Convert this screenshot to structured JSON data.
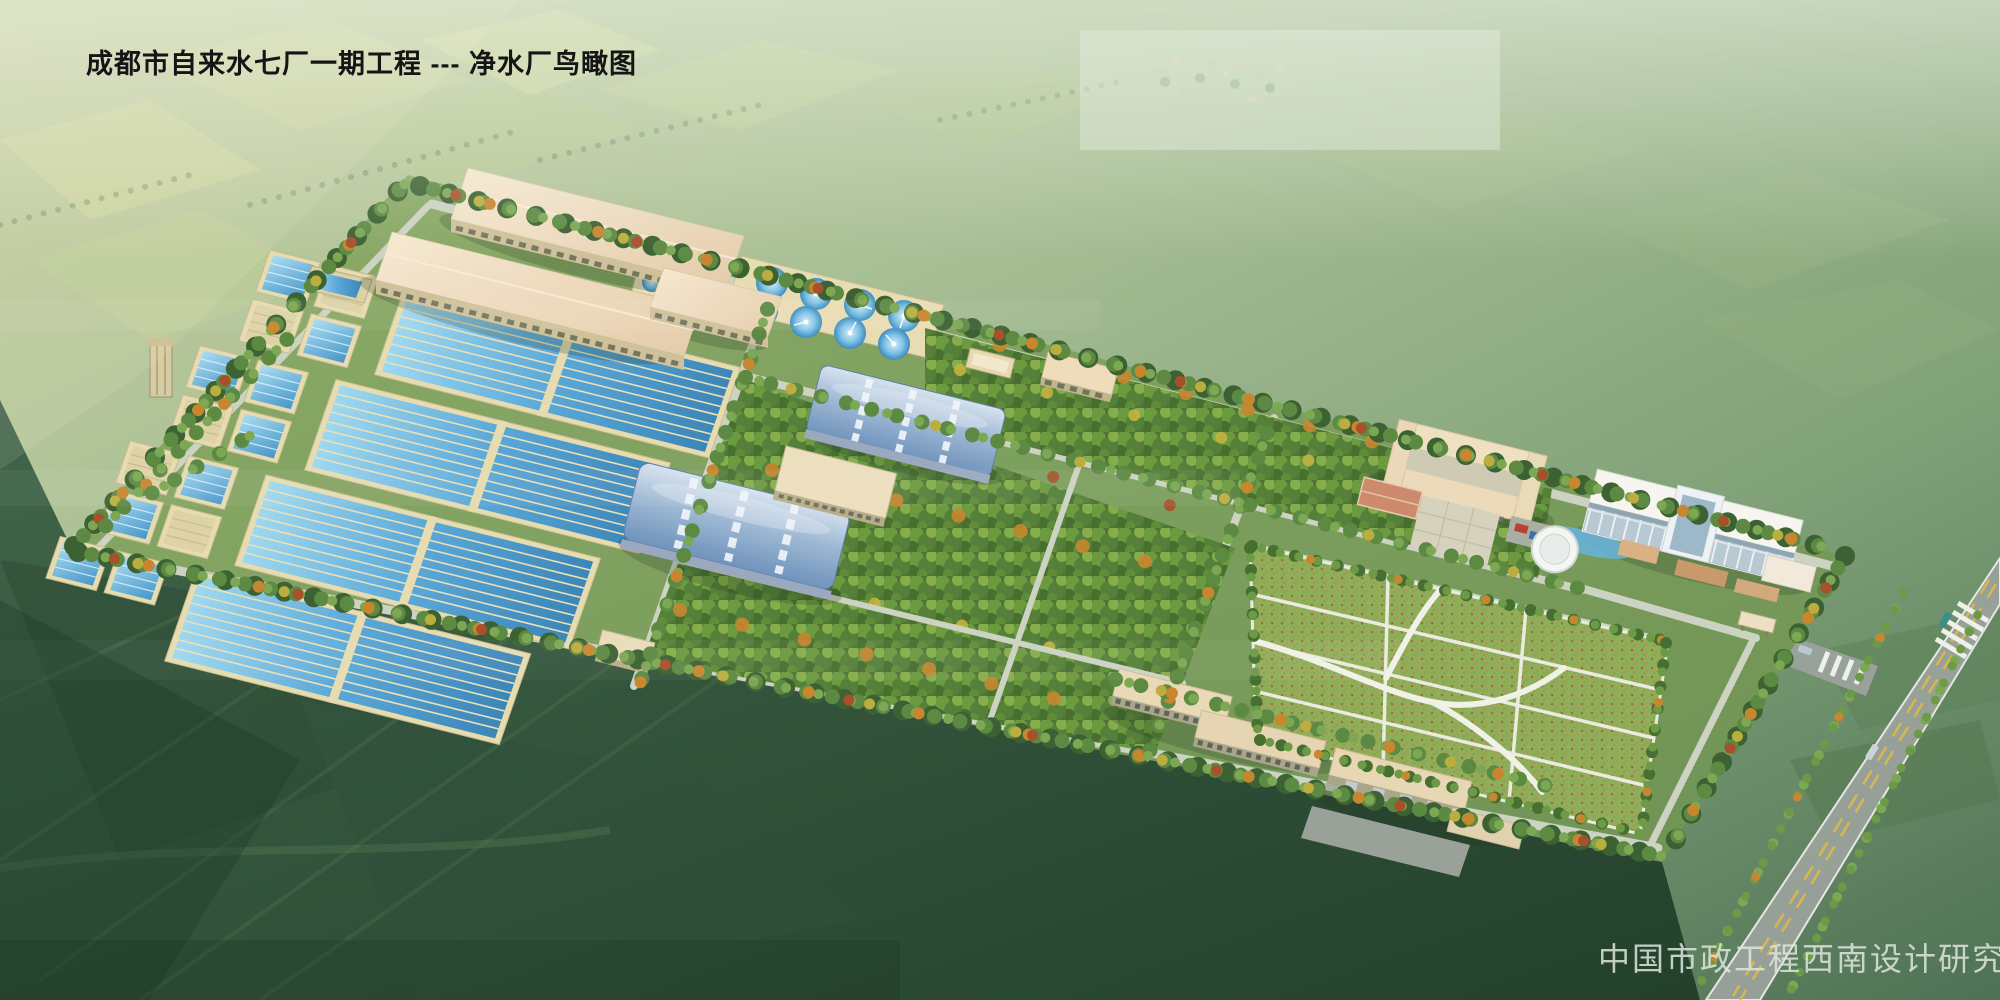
{
  "header": {
    "title": "成都市自来水七厂一期工程 --- 净水厂鸟瞰图"
  },
  "footer": {
    "credit": "中国市政工程西南设计研究总院"
  },
  "colors": {
    "title_color": "#151515",
    "credit_color": "#dde7dd",
    "base_green": "#a9bf95",
    "water": "#4fa3d8",
    "water_deep": "#3c86b8",
    "basin_wall": "#e6dcb0",
    "roof_beige": "#f2e2c6",
    "roof_blue": "#9fb9d4",
    "lawn_green": "#8fae5a",
    "orchard_green": "#55803a",
    "tree_autumn": "#c8862f",
    "road_light": "#cdd3c2",
    "highway_gray": "#99a29a",
    "lane_marking": "#d9b64e",
    "farmland_dark": "#2e4f38"
  },
  "scene": {
    "type": "architectural-aerial-rendering",
    "subject": "water treatment plant bird's-eye view",
    "landmarks": [
      "sedimentation-basins",
      "filter-cells",
      "circular-clarifiers",
      "arched-filter-houses",
      "northwest-workshops",
      "administration-campus",
      "office-building",
      "round-pavilion",
      "basketball-court",
      "lawn-garden",
      "orchard-blocks",
      "south-workshop-row",
      "perimeter-tree-belt",
      "entrance-gate",
      "highway"
    ]
  }
}
